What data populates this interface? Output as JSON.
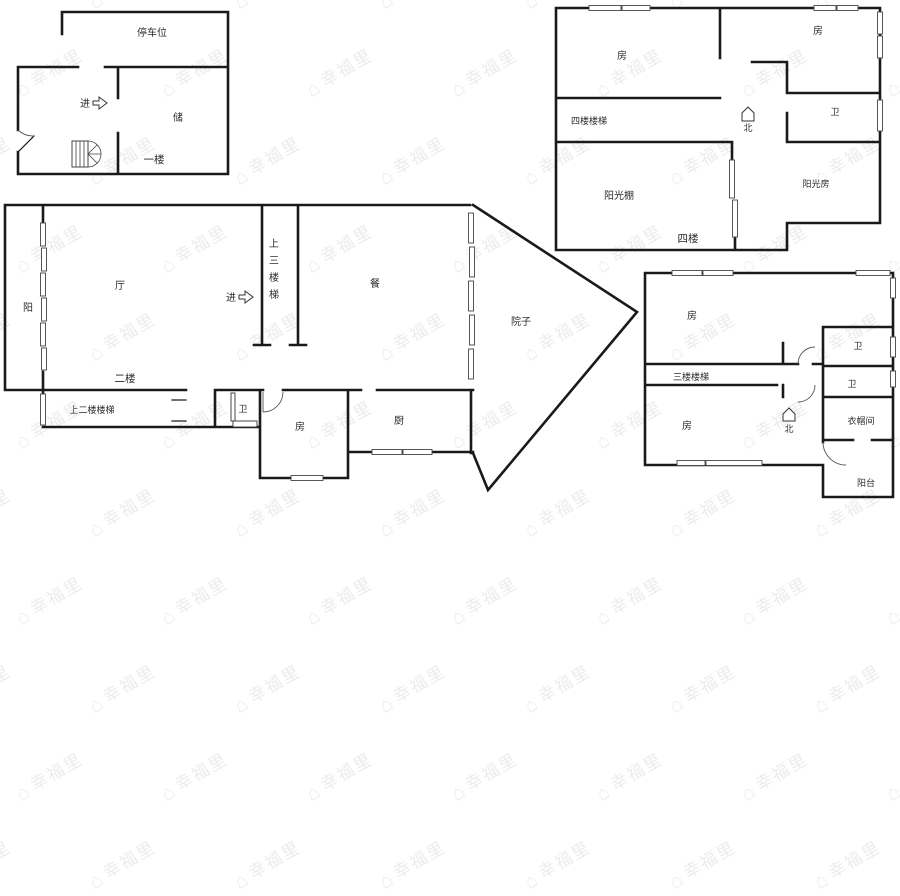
{
  "watermark": {
    "text": "幸福里",
    "logo_icon": "house-icon"
  },
  "colors": {
    "wall": "#1a1a1a",
    "label": "#2b2b2b",
    "watermark": "#ececec",
    "background": "#ffffff"
  },
  "plans": {
    "floor1": {
      "parking": "停车位",
      "entry": "进",
      "storage": "储",
      "floor_label": "一楼"
    },
    "floor2": {
      "balcony": "阳",
      "hall": "厅",
      "entry": "进",
      "stairs_to_3f": "上三楼梯",
      "dining": "餐",
      "yard": "院子",
      "floor_label": "二楼",
      "stairs_to_2f": "上二楼楼梯",
      "bath": "卫",
      "room": "房",
      "kitchen": "厨"
    },
    "floor3": {
      "room_top": "房",
      "stairs": "三楼楼梯",
      "room_bottom": "房",
      "bath_top": "卫",
      "bath_mid": "卫",
      "cloakroom": "衣帽间",
      "balcony": "阳台",
      "north": "北"
    },
    "floor4": {
      "room_left": "房",
      "room_right": "房",
      "stairs": "四楼楼梯",
      "north": "北",
      "bath": "卫",
      "sun_shed": "阳光棚",
      "sun_room": "阳光房",
      "floor_label": "四楼"
    }
  }
}
